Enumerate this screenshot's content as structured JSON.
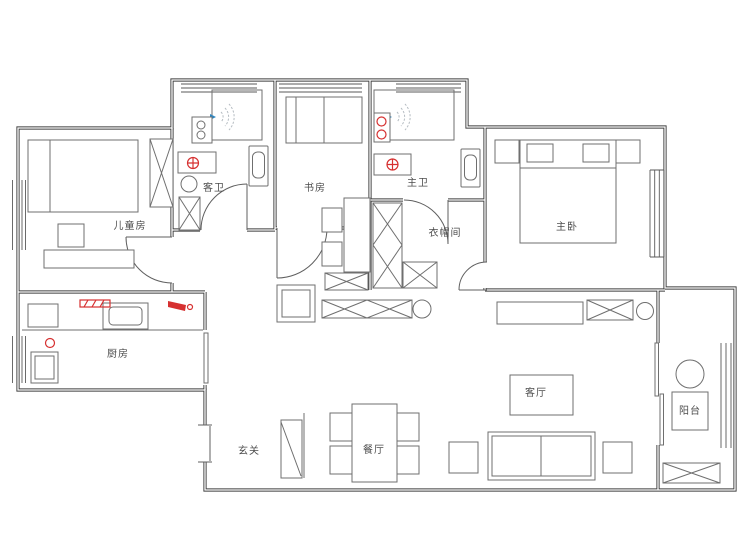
{
  "floorplan": {
    "rooms": [
      {
        "id": "children-room",
        "label": "儿童房"
      },
      {
        "id": "guest-bathroom",
        "label": "客卫"
      },
      {
        "id": "study",
        "label": "书房"
      },
      {
        "id": "master-bathroom",
        "label": "主卫"
      },
      {
        "id": "cloakroom",
        "label": "衣帽间"
      },
      {
        "id": "master-bedroom",
        "label": "主卧"
      },
      {
        "id": "kitchen",
        "label": "厨房"
      },
      {
        "id": "entryway",
        "label": "玄关"
      },
      {
        "id": "dining-room",
        "label": "餐厅"
      },
      {
        "id": "living-room",
        "label": "客厅"
      },
      {
        "id": "balcony",
        "label": "阳台"
      }
    ],
    "colors": {
      "wall": "#3f3f3f",
      "furniture_line": "#6f6f6f",
      "accent_red": "#d63030",
      "spray_gray": "#b5bcc2",
      "nozzle_blue": "#2e86c1",
      "background": "#ffffff"
    }
  }
}
